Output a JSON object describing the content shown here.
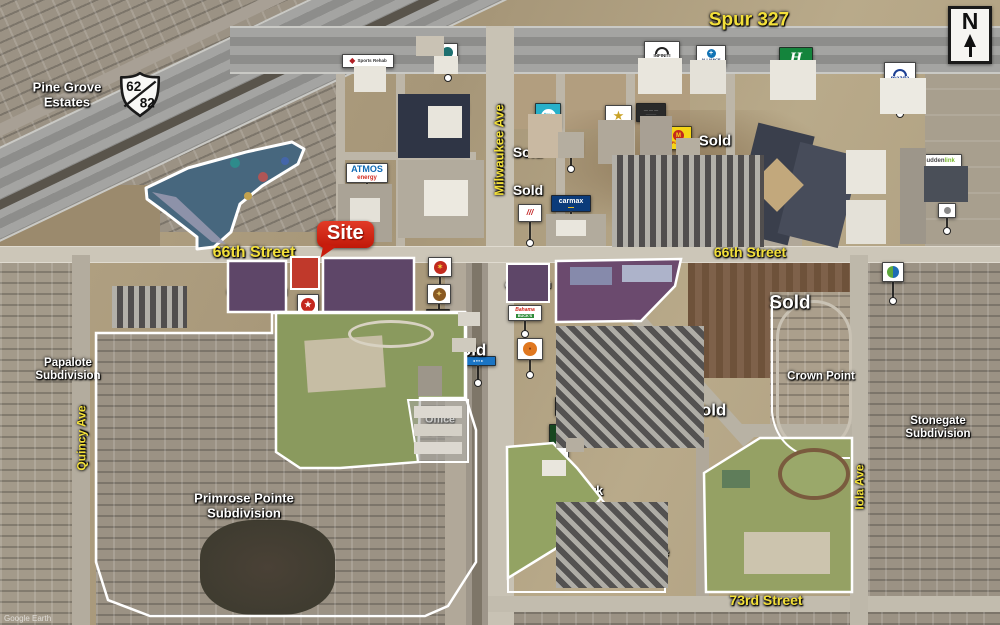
{
  "meta": {
    "attribution": "Google Earth"
  },
  "compass": {
    "letter": "N"
  },
  "highway_shield": {
    "top": "62",
    "bottom": "82"
  },
  "site_callout": {
    "label": "Site"
  },
  "street_labels": [
    {
      "name": "spur-327",
      "lines": [
        "Spur 327"
      ],
      "x": 749,
      "y": 20,
      "size": 19
    },
    {
      "name": "66th-street-west",
      "lines": [
        "66th Street"
      ],
      "x": 254,
      "y": 253,
      "size": 16
    },
    {
      "name": "66th-street-east",
      "lines": [
        "66th Street"
      ],
      "x": 750,
      "y": 253,
      "size": 14
    },
    {
      "name": "73rd-street",
      "lines": [
        "73rd Street"
      ],
      "x": 766,
      "y": 601,
      "size": 14
    },
    {
      "name": "milwaukee-ave",
      "lines": [
        "Milwaukee Ave"
      ],
      "x": 500,
      "y": 150,
      "size": 13,
      "rot": -90
    },
    {
      "name": "quincy-ave",
      "lines": [
        "Quincy Ave"
      ],
      "x": 82,
      "y": 438,
      "size": 12,
      "rot": -90
    },
    {
      "name": "iola-ave",
      "lines": [
        "Iola Ave"
      ],
      "x": 860,
      "y": 487,
      "size": 12,
      "rot": -90
    }
  ],
  "area_labels": [
    {
      "name": "pine-grove-estates",
      "lines": [
        "Pine Grove",
        "Estates"
      ],
      "x": 67,
      "y": 95,
      "size": 13
    },
    {
      "name": "future-commercial-west",
      "lines": [
        "Future",
        "Commercial"
      ],
      "x": 257,
      "y": 287,
      "size": 10.5
    },
    {
      "name": "future-commercial-mid",
      "lines": [
        "Future",
        "Commercial"
      ],
      "x": 369,
      "y": 290,
      "size": 11.5
    },
    {
      "name": "future-commercial-small",
      "lines": [
        "Future",
        "Commercial"
      ],
      "x": 528,
      "y": 282,
      "size": 8
    },
    {
      "name": "future-office-retail",
      "lines": [
        "Future",
        "Office & Retail"
      ],
      "x": 613,
      "y": 291,
      "size": 12
    },
    {
      "name": "oak-ridge-school",
      "lines": [
        "Oak Ridge",
        "Elementary School"
      ],
      "x": 342,
      "y": 381,
      "size": 12.5
    },
    {
      "name": "papalote-subdivision",
      "lines": [
        "Papalote",
        "Subdivision"
      ],
      "x": 68,
      "y": 370,
      "size": 11.5
    },
    {
      "name": "primrose-pointe",
      "lines": [
        "Primrose Pointe",
        "Subdivision"
      ],
      "x": 244,
      "y": 506,
      "size": 13
    },
    {
      "name": "office-park",
      "lines": [
        "Office",
        "Park"
      ],
      "x": 440,
      "y": 426,
      "size": 10.5
    },
    {
      "name": "icon-apartments-north",
      "lines": [
        "The Icon",
        "Apartments"
      ],
      "x": 684,
      "y": 198,
      "size": 11
    },
    {
      "name": "icon-apartments-south",
      "lines": [
        "The Icon",
        "Apartments"
      ],
      "x": 641,
      "y": 375,
      "size": 11.5
    },
    {
      "name": "state-offices",
      "lines": [
        "State",
        "Offices"
      ],
      "x": 784,
      "y": 172,
      "size": 11.5
    },
    {
      "name": "crown-point",
      "lines": [
        "Crown Point"
      ],
      "x": 821,
      "y": 377,
      "size": 11.5
    },
    {
      "name": "stonegate-subdivision",
      "lines": [
        "Stonegate",
        "Subdivision"
      ],
      "x": 938,
      "y": 428,
      "size": 11.5
    },
    {
      "name": "heritage-middle-school",
      "lines": [
        "Heritage",
        "Middle School"
      ],
      "x": 792,
      "y": 512,
      "size": 12
    },
    {
      "name": "proposed-park",
      "lines": [
        "Proposed Park"
      ],
      "x": 559,
      "y": 491,
      "size": 12.5
    },
    {
      "name": "tuscany-place",
      "lines": [
        "Tuscany Place",
        "Apartments"
      ],
      "x": 626,
      "y": 559,
      "size": 12.5
    },
    {
      "name": "sold-1",
      "lines": [
        "Sold"
      ],
      "x": 528,
      "y": 153,
      "size": 14
    },
    {
      "name": "sold-2",
      "lines": [
        "Sold"
      ],
      "x": 528,
      "y": 191,
      "size": 14
    },
    {
      "name": "sold-3",
      "lines": [
        "Sold"
      ],
      "x": 715,
      "y": 142,
      "size": 15
    },
    {
      "name": "sold-4",
      "lines": [
        "Sold"
      ],
      "x": 468,
      "y": 350,
      "size": 17
    },
    {
      "name": "sold-5",
      "lines": [
        "Sold"
      ],
      "x": 790,
      "y": 303,
      "size": 19
    },
    {
      "name": "sold-6",
      "lines": [
        "Sold"
      ],
      "x": 708,
      "y": 410,
      "size": 17
    }
  ],
  "markers": [
    {
      "name": "fore-golf-logo",
      "x": 196,
      "y": 172,
      "w": 44,
      "h": 30,
      "bg": "#fff",
      "glyph": {
        "k": "circle",
        "c": "#2f7d37",
        "d": 12,
        "t": "✚",
        "tc": "#fff",
        "ts": 7
      },
      "lines": [
        {
          "t": "4ORE!",
          "c": "#111",
          "s": 8,
          "b": 1
        }
      ]
    },
    {
      "name": "covenant-sports-rehab-sign",
      "x": 342,
      "y": 54,
      "w": 52,
      "h": 14,
      "bg": "#fff",
      "row": 1,
      "glyph": {
        "k": "diamond",
        "c": "#b01f24",
        "d": 8
      },
      "lines": [
        {
          "t": "Sports Rehab",
          "c": "#333",
          "s": 4.5,
          "b": 1
        }
      ],
      "leader": 14
    },
    {
      "name": "covenant-logo",
      "x": 437,
      "y": 43,
      "w": 21,
      "h": 18,
      "bg": "#fff",
      "glyph": {
        "k": "circle",
        "c": "#1d6f6f",
        "d": 11
      },
      "leader": 14
    },
    {
      "name": "lone-star-state-bank-sign",
      "x": 423,
      "y": 102,
      "w": 45,
      "h": 13,
      "bg": "#fff",
      "row": 1,
      "glyph": {
        "k": "star",
        "c": "#c02020",
        "d": 7
      },
      "lines": [
        {
          "t": "Lone Star State Bank",
          "c": "#1a2f5e",
          "s": 3.8,
          "b": 1
        }
      ],
      "leader": 12
    },
    {
      "name": "nissan-logo",
      "x": 429,
      "y": 161,
      "w": 36,
      "h": 28,
      "bg": "#fff",
      "glyph": {
        "k": "ring",
        "c": "#222",
        "d": 11
      },
      "lines": [
        {
          "t": "NISSAN",
          "c": "#111",
          "s": 5,
          "b": 1
        }
      ],
      "leader": 12
    },
    {
      "name": "atmos-energy-logo",
      "x": 346,
      "y": 163,
      "w": 42,
      "h": 20,
      "bg": "#fff",
      "lines": [
        {
          "t": "ATMOS",
          "c": "#0f6ab4",
          "s": 9,
          "b": 1
        },
        {
          "t": "energy",
          "c": "#d12c20",
          "s": 6,
          "b": 1
        }
      ],
      "leader": 16
    },
    {
      "name": "tru-hotel-logo",
      "x": 535,
      "y": 103,
      "w": 26,
      "h": 26,
      "bg": "#28b0c9",
      "glyph": {
        "k": "circle",
        "c": "#fff",
        "d": 15,
        "t": "tru",
        "tc": "#28b0c9",
        "ts": 6
      },
      "leader": 16
    },
    {
      "name": "hotel-sign-dark-red",
      "x": 559,
      "y": 137,
      "w": 23,
      "h": 17,
      "bg": "#77202c",
      "lines": [
        {
          "t": "— — —",
          "c": "#e8d8c8",
          "s": 4
        }
      ],
      "leader": 12
    },
    {
      "name": "gold-palm-logo",
      "x": 605,
      "y": 105,
      "w": 27,
      "h": 21,
      "bg": "#fff",
      "glyph": {
        "k": "star",
        "c": "#c9a227",
        "d": 13
      },
      "leader": 22
    },
    {
      "name": "black-hotel-sign",
      "x": 636,
      "y": 103,
      "w": 30,
      "h": 19,
      "bg": "#2a2a2a",
      "lines": [
        {
          "t": "— — —",
          "c": "#ccc",
          "s": 4
        },
        {
          "t": "———",
          "c": "#888",
          "s": 3.5
        }
      ],
      "leader": 18
    },
    {
      "name": "place-logo",
      "x": 665,
      "y": 126,
      "w": 27,
      "h": 24,
      "bg": "#f5d516",
      "glyph": {
        "k": "circle",
        "c": "#c4271d",
        "d": 11,
        "t": "M",
        "tc": "#f5d516",
        "ts": 6
      },
      "lines": [
        {
          "t": "PLACE",
          "c": "#c4271d",
          "s": 4,
          "b": 1
        }
      ],
      "leader": 12
    },
    {
      "name": "carmax-logo",
      "x": 551,
      "y": 195,
      "w": 40,
      "h": 17,
      "bg": "#0b3b7a",
      "lines": [
        {
          "t": "carmax",
          "c": "#fff",
          "s": 7,
          "b": 1
        },
        {
          "t": "▬▬",
          "c": "#f7c520",
          "s": 3
        }
      ],
      "leader": 18
    },
    {
      "name": "red-stripe-logo",
      "x": 518,
      "y": 204,
      "w": 24,
      "h": 18,
      "bg": "#fff",
      "glyph": {
        "k": "slashes",
        "c": "#c22222",
        "d": 8
      },
      "leader": 18
    },
    {
      "name": "infiniti-logo",
      "x": 644,
      "y": 41,
      "w": 36,
      "h": 23,
      "bg": "#fff",
      "glyph": {
        "k": "arc",
        "c": "#222"
      },
      "lines": [
        {
          "t": "INFINITI",
          "c": "#222",
          "s": 4.5,
          "b": 1
        }
      ],
      "leader": 16
    },
    {
      "name": "alliance-logo",
      "x": 696,
      "y": 45,
      "w": 30,
      "h": 22,
      "bg": "#fff",
      "glyph": {
        "k": "circle",
        "c": "#1273b5",
        "d": 9,
        "t": "+",
        "tc": "#fff",
        "ts": 7
      },
      "lines": [
        {
          "t": "ALLIANCE",
          "c": "#1a2f5e",
          "s": 3.8,
          "b": 1
        }
      ],
      "leader": 16
    },
    {
      "name": "holiday-inn-express-logo",
      "x": 779,
      "y": 47,
      "w": 34,
      "h": 22,
      "bg": "#14843c",
      "glyph": {
        "k": "script",
        "c": "#fff",
        "t": "H",
        "d": 13
      },
      "leader": 18
    },
    {
      "name": "mazda-logo",
      "x": 884,
      "y": 62,
      "w": 32,
      "h": 27,
      "bg": "#fff",
      "glyph": {
        "k": "arc",
        "c": "#1c3f94"
      },
      "lines": [
        {
          "t": "mazda",
          "c": "#1c3f94",
          "s": 6,
          "b": 1
        }
      ],
      "leader": 22
    },
    {
      "name": "state-office-building-logo",
      "x": 764,
      "y": 194,
      "w": 24,
      "h": 21,
      "bg": "#fff",
      "glyph": {
        "k": "half2",
        "c": "#2e7d32",
        "c2": "#1565c0",
        "d": 11
      },
      "leader": 14
    },
    {
      "name": "suddenlink-logo",
      "x": 916,
      "y": 154,
      "w": 46,
      "h": 14,
      "bg": "#fff",
      "lines": [
        {
          "parts": [
            {
              "t": "sudden",
              "c": "#4a4a4a"
            },
            {
              "t": "link",
              "c": "#76b82a"
            }
          ],
          "s": 6,
          "b": 1
        }
      ],
      "leader": 16
    },
    {
      "name": "small-white-logo",
      "x": 938,
      "y": 203,
      "w": 18,
      "h": 15,
      "bg": "#fff",
      "glyph": {
        "k": "circle",
        "c": "#888",
        "d": 7
      },
      "leader": 10
    },
    {
      "name": "bank-circle-logo",
      "x": 882,
      "y": 262,
      "w": 22,
      "h": 20,
      "bg": "#fff",
      "glyph": {
        "k": "half2",
        "c": "#5da83c",
        "c2": "#1e6db5",
        "d": 12
      },
      "leader": 16
    },
    {
      "name": "red-circle-logo",
      "x": 428,
      "y": 257,
      "w": 24,
      "h": 20,
      "bg": "#fff",
      "glyph": {
        "k": "circle",
        "c": "#c22a1e",
        "d": 13,
        "t": "✶",
        "tc": "#f3d23e",
        "ts": 7
      },
      "leader": 8
    },
    {
      "name": "gold-crest-logo",
      "x": 427,
      "y": 284,
      "w": 24,
      "h": 20,
      "bg": "#fff",
      "glyph": {
        "k": "circle",
        "c": "#8a5a22",
        "d": 13,
        "t": "✦",
        "tc": "#e5c36a",
        "ts": 7
      },
      "leader": 8
    },
    {
      "name": "black-gold-sign",
      "x": 426,
      "y": 309,
      "w": 24,
      "h": 20,
      "bg": "#17130d",
      "lines": [
        {
          "t": "━━",
          "c": "#c9a24a",
          "s": 4
        },
        {
          "t": "━━",
          "c": "#c9a24a",
          "s": 4
        }
      ],
      "leader": 8
    },
    {
      "name": "yellow-circle-logo",
      "x": 427,
      "y": 332,
      "w": 24,
      "h": 20,
      "bg": "#fff",
      "glyph": {
        "k": "circle",
        "c": "#e7c52e",
        "d": 13
      },
      "leader": 8
    },
    {
      "name": "dance-studio-sign",
      "x": 417,
      "y": 347,
      "w": 29,
      "h": 19,
      "bg": "#fff",
      "lines": [
        {
          "t": "Dance",
          "c": "#111",
          "s": 5.5,
          "b": 1
        },
        {
          "t": "Studio",
          "c": "#111",
          "s": 5.5,
          "b": 1
        }
      ],
      "leader": 16
    },
    {
      "name": "blue-sign",
      "x": 460,
      "y": 356,
      "w": 36,
      "h": 10,
      "bg": "#1a74c4",
      "lines": [
        {
          "t": "◂ ▪▪▪ ▸",
          "c": "#fff",
          "s": 4
        }
      ],
      "leader": 14
    },
    {
      "name": "bahama-bucks-logo",
      "x": 508,
      "y": 305,
      "w": 34,
      "h": 16,
      "bg": "#fff",
      "lines": [
        {
          "t": "Bahama",
          "c": "#d02318",
          "s": 5,
          "b": 1,
          "i": 1
        },
        {
          "t": "BUCK'S",
          "c": "#fff",
          "s": 3.8,
          "b": 1,
          "bgc": "#2e8b3a"
        }
      ],
      "leader": 10
    },
    {
      "name": "orange-circle-logo",
      "x": 517,
      "y": 338,
      "w": 26,
      "h": 22,
      "bg": "#fff",
      "glyph": {
        "k": "circle",
        "c": "#e07820",
        "d": 14,
        "t": "●",
        "tc": "#8a3c10",
        "ts": 5
      },
      "leader": 12
    },
    {
      "name": "funky-sign",
      "x": 555,
      "y": 397,
      "w": 30,
      "h": 19,
      "bg": "#0d0d0d",
      "lines": [
        {
          "t": "Funky",
          "c": "#eee",
          "s": 7,
          "b": 1,
          "i": 1
        },
        {
          "t": "━━━",
          "c": "#c4271d",
          "s": 3
        }
      ]
    },
    {
      "name": "site-parcel-logo",
      "x": 297,
      "y": 294,
      "w": 22,
      "h": 22,
      "bg": "#fff",
      "glyph": {
        "k": "circle",
        "c": "#c4271d",
        "d": 14,
        "t": "★",
        "tc": "#fff",
        "ts": 8
      },
      "leader": 12
    },
    {
      "name": "wendys-logo",
      "x": 541,
      "y": 447,
      "w": 28,
      "h": 26,
      "bg": "#fff",
      "lines": [
        {
          "t": "Wendy's",
          "c": "#c4271d",
          "s": 5,
          "b": 1,
          "i": 1
        },
        {
          "t": "▬▬▬",
          "c": "#f0b51e",
          "s": 3.5
        },
        {
          "t": "▬▬▬",
          "c": "#c4271d",
          "s": 3.5
        }
      ]
    },
    {
      "name": "green-script-logo",
      "x": 549,
      "y": 424,
      "w": 26,
      "h": 21,
      "bg": "#17471f",
      "glyph": {
        "k": "script",
        "c": "#e8c93e",
        "t": "T",
        "d": 11
      }
    }
  ]
}
